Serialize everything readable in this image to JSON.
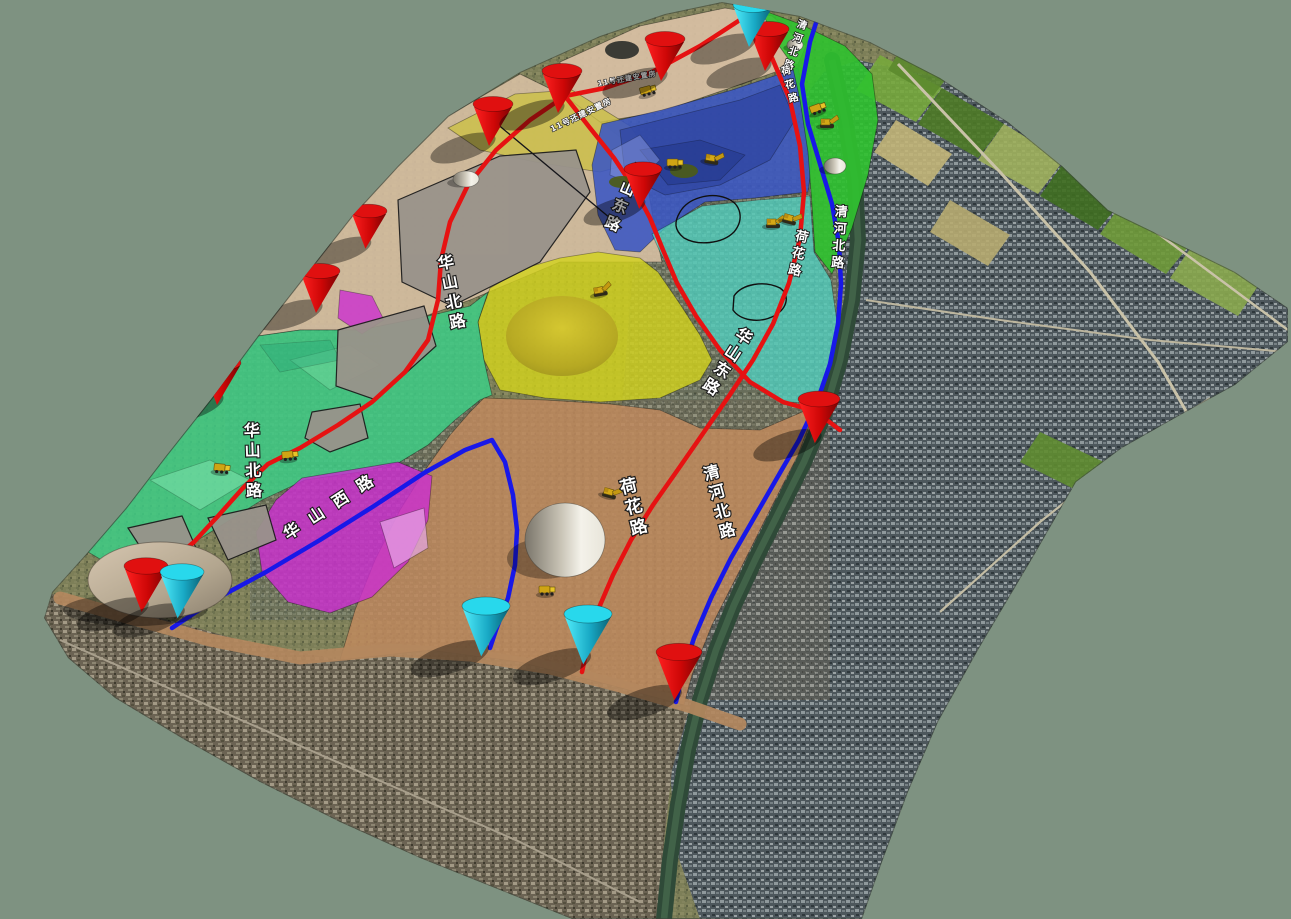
{
  "scene": {
    "background_color": "#7E9281",
    "viewport_width": 1291,
    "viewport_height": 919
  },
  "terrain": {
    "outline": "722,2 800,16 870,42 940,78 1008,122 1062,166 1108,210 1170,240 1235,272 1288,308 1288,342 1235,385 1175,418 1122,448 1076,482 1036,552 978,650 938,722 908,792 882,862 862,919 572,919 500,890 420,858 340,822 260,782 185,740 115,698 68,658 44,618 52,592 88,552 126,508 166,456 212,398 258,336 308,272 352,216 398,166 448,116 520,72 600,36 665,14",
    "edge_color": "#3c463c",
    "regions": [
      {
        "name": "city-right",
        "fill": "pattern:city",
        "opacity": 1,
        "points": "858,60 940,78 1008,122 1062,166 1108,210 1170,240 1235,272 1288,308 1288,342 1235,385 1175,418 1122,448 1076,482 1036,552 978,650 938,722 908,792 882,862 862,919 700,919 676,850 670,770 674,700 692,640 714,596 742,545 772,498 802,450 824,408 838,360 844,300 840,240 822,170 802,100 824,72"
      },
      {
        "name": "city-bottom-left",
        "fill": "pattern:cityb",
        "opacity": 1,
        "points": "52,594 140,612 240,640 340,660 430,650 520,662 610,685 690,706 672,770 664,840 658,919 572,919 500,890 420,858 340,822 260,782 185,740 115,698 68,658 44,618"
      },
      {
        "name": "town-center",
        "fill": "pattern:city",
        "opacity": 0.45,
        "points": "640,180 845,180 845,430 620,430"
      },
      {
        "name": "town-bottom",
        "fill": "pattern:cityb",
        "opacity": 0.4,
        "points": "370,400 830,400 830,700 370,700"
      },
      {
        "name": "town-left",
        "fill": "pattern:city",
        "opacity": 0.3,
        "points": "225,325 480,325 480,470 225,470"
      },
      {
        "name": "town-magenta",
        "fill": "pattern:city",
        "opacity": 0.35,
        "points": "250,460 440,460 440,620 250,620"
      }
    ]
  },
  "farm_patches": [
    {
      "points": "880,55 942,88 916,122 856,90",
      "color": "#77a83c"
    },
    {
      "points": "942,88 1004,124 978,158 918,124",
      "color": "#4e7a26"
    },
    {
      "points": "1004,124 1064,160 1038,194 978,160",
      "color": "#9fb05c"
    },
    {
      "points": "1064,162 1124,198 1098,230 1040,196",
      "color": "#3f6e20"
    },
    {
      "points": "896,120 952,154 928,186 874,152",
      "color": "#c2b578"
    },
    {
      "points": "1124,200 1192,242 1166,274 1100,234",
      "color": "#6f9a38"
    },
    {
      "points": "1192,246 1258,286 1238,316 1170,278",
      "color": "#8aa84e"
    },
    {
      "points": "905,42 953,70 933,96 888,70",
      "color": "#5c8a2e"
    },
    {
      "points": "1040,432 1108,464 1084,494 1020,462",
      "color": "#5f8c30"
    },
    {
      "points": "950,200 1010,235 988,266 930,232",
      "color": "#b7ab70"
    }
  ],
  "satellite_roads": [
    {
      "points": "898,64 1000,172 1090,272 1158,362 1198,432 1212,500",
      "width": 3,
      "color": "#c9c2a8"
    },
    {
      "points": "1062,162 1160,235 1288,330",
      "width": 2.5,
      "color": "#c9c2a8"
    },
    {
      "points": "866,300 1000,320 1150,340 1286,352",
      "width": 2,
      "color": "#bdb69e"
    },
    {
      "points": "940,612 1040,522 1128,452 1210,398",
      "width": 2.2,
      "color": "#c4bda4"
    },
    {
      "points": "60,640 200,702 360,772 520,842 640,902",
      "width": 2,
      "color": "#a89f8c"
    }
  ],
  "river": {
    "points": "832,60 845,120 855,180 858,240 852,300 840,360 824,415 804,462 780,510 756,558 734,605 716,650 700,700 688,750 678,805 670,860 664,919",
    "width": 16,
    "color": "#2f4a38",
    "glint": "#547a58"
  },
  "embankment": {
    "points": "60,598 130,618 210,640 300,658 390,650 470,655 550,668 620,686 688,706 740,724",
    "width": 13,
    "color": "#b4885e"
  },
  "zones": [
    {
      "name": "tan-top-strip",
      "color": "#d9c1a4",
      "opacity": 0.92,
      "points": "560,62 640,26 725,8 772,16 806,46 798,64 730,88 660,112 600,122 565,96"
    },
    {
      "name": "tan-left-parcels",
      "color": "#d6bfa2",
      "opacity": 0.9,
      "points": "398,166 448,116 520,74 565,96 600,122 640,152 648,188 655,230 662,262 640,262 560,262 470,300 420,318 360,330 300,330 258,336 308,272 352,216"
    },
    {
      "name": "khaki-strip",
      "color": "#ccc04a",
      "opacity": 0.85,
      "points": "448,128 515,94 572,90 630,126 652,158 600,172 535,162 480,150"
    },
    {
      "name": "blue-mountain-zone",
      "color": "#3b57c4",
      "opacity": 0.88,
      "points": "602,124 662,110 732,90 798,68 806,112 812,162 808,192 755,198 705,202 665,228 640,252 615,250 598,215 592,165"
    },
    {
      "name": "mountain-rock-1",
      "color": "#2e44a0",
      "opacity": 0.7,
      "points": "620,130 680,115 740,100 780,85 795,120 770,160 720,185 665,195 625,175"
    },
    {
      "name": "mountain-rock-2",
      "color": "#24388c",
      "opacity": 0.6,
      "points": "640,150 700,140 745,155 720,180 668,185"
    },
    {
      "name": "mountain-ridge-light",
      "color": "#8a9ae0",
      "opacity": 0.5,
      "points": "612,150 640,135 660,160 635,185 610,175"
    },
    {
      "name": "green-top-strip",
      "color": "#2fc32f",
      "opacity": 0.9,
      "points": "762,10 800,24 845,46 872,74 878,120 868,175 852,228 832,274 815,252 812,205 808,152 800,100 792,64 772,36"
    },
    {
      "name": "teal-zone",
      "color": "#4fd8c8",
      "opacity": 0.72,
      "points": "652,234 702,206 758,200 810,196 814,252 831,280 837,322 830,368 817,403 786,402 751,382 721,350 695,315 675,281 660,252"
    },
    {
      "name": "yellow-zone",
      "color": "#d4d41c",
      "opacity": 0.8,
      "points": "598,252 640,258 658,272 680,304 700,335 712,360 700,380 660,398 600,402 545,398 500,390 484,360 478,322 490,288 525,268 560,258"
    },
    {
      "name": "green-left-zone",
      "color": "#3ecd85",
      "opacity": 0.85,
      "points": "258,336 300,330 360,330 420,318 470,306 488,292 478,322 484,360 492,395 480,400 455,420 428,445 400,462 360,472 305,480 262,500 222,525 185,548 150,562 110,565 88,552 126,508 166,456 212,398"
    },
    {
      "name": "green-light-patch-1",
      "color": "#8ae8b8",
      "opacity": 0.45,
      "points": "150,480 210,460 250,480 200,510"
    },
    {
      "name": "green-light-patch-2",
      "color": "#7fe0a8",
      "opacity": 0.4,
      "points": "290,360 350,345 380,365 330,390"
    },
    {
      "name": "green-dark-patch",
      "color": "#2aa878",
      "opacity": 0.4,
      "points": "260,345 330,340 340,360 280,372"
    },
    {
      "name": "tan-bottom-zone",
      "color": "#c28a5e",
      "opacity": 0.82,
      "points": "484,398 545,400 610,404 660,410 700,428 760,430 816,406 798,455 770,510 740,570 712,625 692,675 684,705 610,685 520,662 430,650 340,660 355,610 375,560 400,510 425,470 450,435 470,412"
    },
    {
      "name": "magenta-zone-big",
      "color": "#cc2fd0",
      "opacity": 0.82,
      "points": "302,478 398,462 432,476 428,520 408,562 372,597 330,613 288,602 262,572 256,532 276,500"
    },
    {
      "name": "pink-patch",
      "color": "#e8a8e8",
      "opacity": 0.7,
      "points": "380,522 424,508 428,548 394,568"
    },
    {
      "name": "magenta-zone-small",
      "color": "#cc2fd0",
      "opacity": 0.8,
      "points": "340,290 372,296 384,320 362,334 338,318"
    },
    {
      "name": "gray-parcel-1",
      "color": "#99938b",
      "opacity": 0.95,
      "stroke": "#1d1d1d",
      "points": "398,200 500,156 576,150 590,192 540,262 452,306 402,282"
    },
    {
      "name": "gray-parcel-2",
      "color": "#99938b",
      "opacity": 0.95,
      "stroke": "#1d1d1d",
      "points": "338,330 424,306 436,346 376,400 336,386"
    },
    {
      "name": "gray-parcel-3",
      "color": "#99938b",
      "opacity": 0.95,
      "stroke": "#1d1d1d",
      "points": "312,412 360,404 368,438 330,452 305,438"
    },
    {
      "name": "gray-parcel-4",
      "color": "#99938b",
      "opacity": 0.95,
      "stroke": "#1d1d1d",
      "points": "128,528 182,516 196,548 150,562"
    },
    {
      "name": "gray-parcel-5",
      "color": "#99938b",
      "opacity": 0.95,
      "stroke": "#1d1d1d",
      "points": "208,518 266,505 276,540 228,560"
    }
  ],
  "boundary_lines": [
    {
      "points": "490,118 622,228",
      "width": 1.3,
      "color": "#15151a"
    }
  ],
  "construction_loops": [
    {
      "path": "M680,212 C688,198 710,192 726,198 C742,204 744,220 734,232 C722,244 698,246 684,238 C674,230 674,222 680,212 Z"
    },
    {
      "path": "M734,296 C742,284 764,280 780,288 C790,295 788,308 774,316 C758,324 740,320 733,310 Z"
    }
  ],
  "roads": {
    "red_color": "#e61212",
    "blue_color": "#1818e8",
    "width": 4.5,
    "red": [
      {
        "name": "top-connector",
        "points": "746,16 700,46 652,72 605,88 565,96"
      },
      {
        "name": "huashan-north-road",
        "points": "565,96 530,120 496,150 468,185 450,222 441,260 438,300 428,340 405,372 372,402 338,425 300,448 268,464 243,488 218,516 194,542 170,562 152,575"
      },
      {
        "name": "huashan-east-road",
        "points": "565,96 590,128 614,158 634,188 650,218 663,250 677,283 696,316 720,350 750,382 783,402 815,411 840,430"
      },
      {
        "name": "hehua-road",
        "points": "746,16 772,58 790,100 800,146 804,192 800,238 789,283 773,324 753,360 729,396 704,432 679,468 653,505 631,540 613,575 598,610 588,644 582,672"
      }
    ],
    "blue": [
      {
        "name": "qinghe-north-road",
        "points": "822,4 810,42 802,84 808,124 820,164 832,204 839,244 841,284 838,324 830,364 817,402 799,440 777,478 754,518 731,558 711,598 694,638 683,672 676,702"
      },
      {
        "name": "huashan-west-road",
        "points": "172,628 214,600 266,572 320,540 374,506 424,473 465,450 492,440 505,462 513,495 517,530 515,565 508,598 496,630 490,648"
      }
    ]
  },
  "road_labels": [
    {
      "text": "华山北路",
      "x": 447,
      "y": 268,
      "size": 16,
      "rotate": -11,
      "dir": "v"
    },
    {
      "text": "华山东路",
      "x": 633,
      "y": 176,
      "size": 15,
      "rotate": 23,
      "dir": "v"
    },
    {
      "text": "清河北路",
      "x": 801,
      "y": 28,
      "size": 10,
      "rotate": 18,
      "dir": "v"
    },
    {
      "text": "荷花路",
      "x": 787,
      "y": 74,
      "size": 10,
      "rotate": -15,
      "dir": "v"
    },
    {
      "text": "清河北路",
      "x": 841,
      "y": 216,
      "size": 13,
      "rotate": 4,
      "dir": "v"
    },
    {
      "text": "荷花路",
      "x": 801,
      "y": 241,
      "size": 13,
      "rotate": 12,
      "dir": "v"
    },
    {
      "text": "华山东路",
      "x": 741,
      "y": 341,
      "size": 16,
      "rotate": 33,
      "dir": "v"
    },
    {
      "text": "荷花路",
      "x": 630,
      "y": 492,
      "size": 17,
      "rotate": -14,
      "dir": "v"
    },
    {
      "text": "清河北路",
      "x": 713,
      "y": 478,
      "size": 16,
      "rotate": -15,
      "dir": "v"
    },
    {
      "text": "华山北路",
      "x": 252,
      "y": 436,
      "size": 16,
      "rotate": -2,
      "dir": "v"
    },
    {
      "text": "华山西路",
      "x": 288,
      "y": 540,
      "size": 16,
      "rotate": -33,
      "dir": "h",
      "spacing": 13
    }
  ],
  "area_labels": [
    {
      "text": "11号还建安置房",
      "x": 598,
      "y": 86,
      "size": 7,
      "rotate": -10,
      "dir": "h",
      "spacing": 1
    },
    {
      "text": "11号还建安置房",
      "x": 552,
      "y": 132,
      "size": 8,
      "rotate": -26,
      "dir": "h",
      "spacing": 1
    }
  ],
  "marker_colors": {
    "red": "#e01010",
    "cyan": "#28d8ec"
  },
  "markers": [
    {
      "type": "red",
      "x": 493,
      "y": 104,
      "s": 1
    },
    {
      "type": "red",
      "x": 562,
      "y": 71,
      "s": 1
    },
    {
      "type": "red",
      "x": 665,
      "y": 39,
      "s": 1
    },
    {
      "type": "red",
      "x": 769,
      "y": 29,
      "s": 1
    },
    {
      "type": "red",
      "x": 369,
      "y": 211,
      "s": 0.9
    },
    {
      "type": "red",
      "x": 320,
      "y": 271,
      "s": 1
    },
    {
      "type": "red",
      "x": 221,
      "y": 363,
      "s": 1
    },
    {
      "type": "red",
      "x": 643,
      "y": 169,
      "s": 0.95
    },
    {
      "type": "red",
      "x": 819,
      "y": 399,
      "s": 1.05
    },
    {
      "type": "red",
      "x": 146,
      "y": 566,
      "s": 1.1
    },
    {
      "type": "red",
      "x": 679,
      "y": 652,
      "s": 1.15
    },
    {
      "type": "cyan",
      "x": 753,
      "y": 5,
      "s": 1
    },
    {
      "type": "cyan",
      "x": 182,
      "y": 572,
      "s": 1.1
    },
    {
      "type": "cyan",
      "x": 486,
      "y": 606,
      "s": 1.2
    },
    {
      "type": "cyan",
      "x": 588,
      "y": 614,
      "s": 1.2
    }
  ],
  "equipment": [
    {
      "type": "truck",
      "x": 648,
      "y": 90,
      "r": -15
    },
    {
      "type": "truck",
      "x": 675,
      "y": 163,
      "r": 0
    },
    {
      "type": "excavator",
      "x": 712,
      "y": 158,
      "r": 10
    },
    {
      "type": "excavator",
      "x": 773,
      "y": 222,
      "r": 0
    },
    {
      "type": "excavator",
      "x": 790,
      "y": 218,
      "r": 15
    },
    {
      "type": "truck",
      "x": 818,
      "y": 108,
      "r": -20
    },
    {
      "type": "excavator",
      "x": 827,
      "y": 122,
      "r": 0
    },
    {
      "type": "excavator",
      "x": 600,
      "y": 290,
      "r": -10
    },
    {
      "type": "truck",
      "x": 222,
      "y": 468,
      "r": 5
    },
    {
      "type": "truck",
      "x": 290,
      "y": 455,
      "r": -5
    },
    {
      "type": "excavator",
      "x": 610,
      "y": 492,
      "r": 15
    },
    {
      "type": "truck",
      "x": 547,
      "y": 590,
      "r": 0
    }
  ],
  "mounds": [
    {
      "kind": "dome",
      "x": 565,
      "y": 540,
      "rx": 40,
      "ry": 37
    },
    {
      "kind": "pile",
      "x": 466,
      "y": 179,
      "rx": 13,
      "ry": 8
    },
    {
      "kind": "pile",
      "x": 795,
      "y": 45,
      "rx": 8,
      "ry": 6
    },
    {
      "kind": "pile",
      "x": 835,
      "y": 166,
      "rx": 11,
      "ry": 8
    },
    {
      "kind": "dark",
      "x": 622,
      "y": 50,
      "rx": 17,
      "ry": 9
    },
    {
      "kind": "hill",
      "x": 160,
      "y": 580,
      "rx": 72,
      "ry": 38
    },
    {
      "kind": "tree",
      "x": 291,
      "y": 240,
      "rx": 10,
      "ry": 6
    },
    {
      "kind": "tree",
      "x": 622,
      "y": 182,
      "rx": 13,
      "ry": 6
    },
    {
      "kind": "tree",
      "x": 684,
      "y": 171,
      "rx": 14,
      "ry": 7
    },
    {
      "kind": "yhill",
      "x": 562,
      "y": 336,
      "rx": 56,
      "ry": 40
    }
  ]
}
